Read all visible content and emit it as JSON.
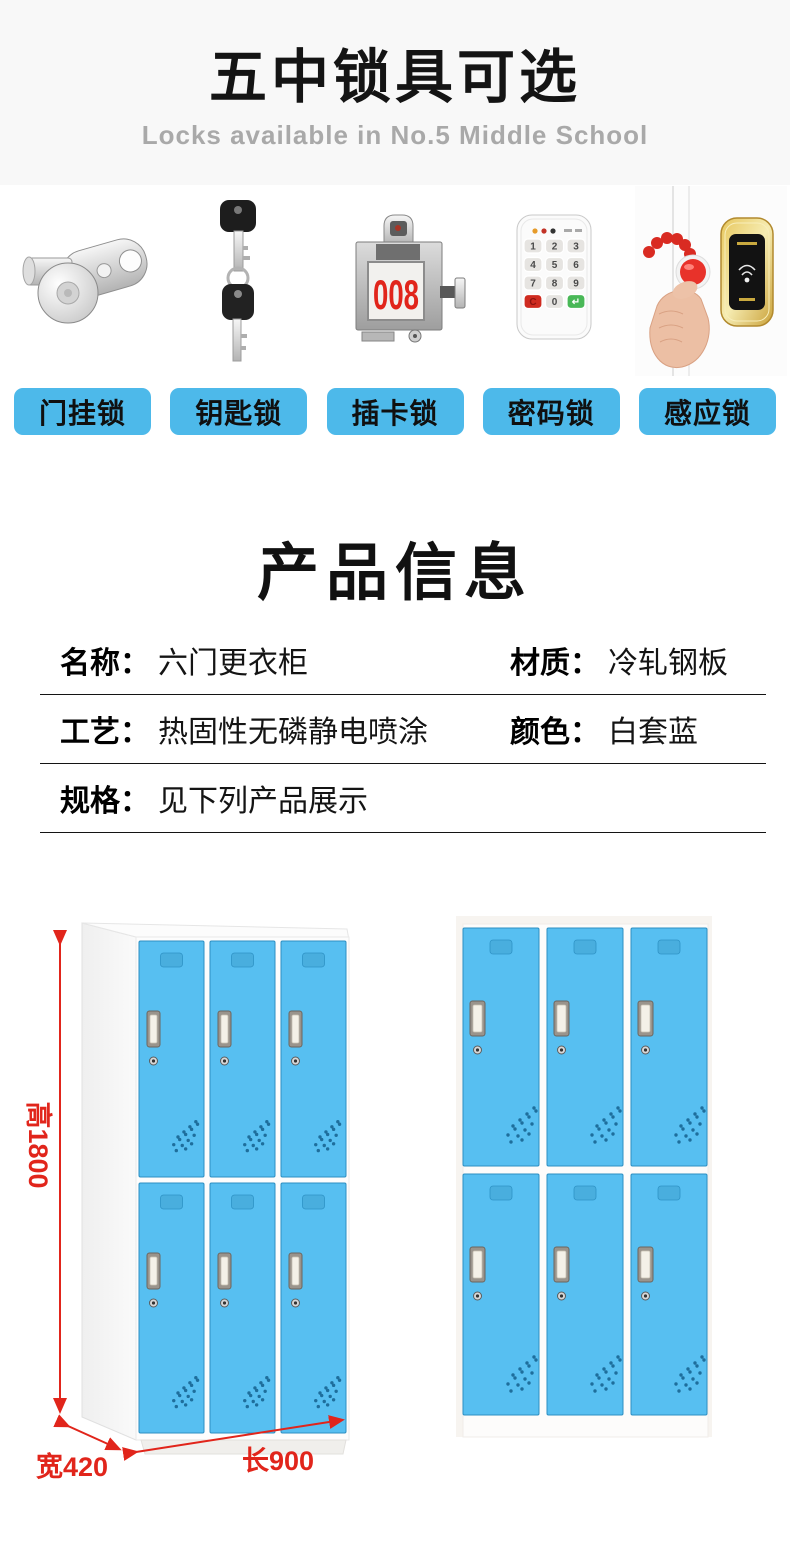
{
  "hero": {
    "title": "五中锁具可选",
    "subtitle": "Locks available in No.5 Middle School"
  },
  "locks": {
    "button_color": "#4db9ea",
    "items": [
      {
        "label": "门挂锁",
        "icon": "cam-lock-icon"
      },
      {
        "label": "钥匙锁",
        "icon": "key-lock-icon"
      },
      {
        "label": "插卡锁",
        "icon": "card-lock-icon",
        "display_number": "008"
      },
      {
        "label": "密码锁",
        "icon": "keypad-lock-icon",
        "keypad_keys": [
          "1",
          "2",
          "3",
          "4",
          "5",
          "6",
          "7",
          "8",
          "9",
          "C",
          "0",
          "↵"
        ]
      },
      {
        "label": "感应锁",
        "icon": "rfid-lock-icon"
      }
    ]
  },
  "product_info": {
    "title": "产品信息",
    "rows": [
      {
        "cells": [
          {
            "label": "名称：",
            "value": "六门更衣柜"
          },
          {
            "label": "材质：",
            "value": "冷轧钢板"
          }
        ]
      },
      {
        "cells": [
          {
            "label": "工艺：",
            "value": "热固性无磷静电喷涂"
          },
          {
            "label": "颜色：",
            "value": "白套蓝"
          }
        ]
      },
      {
        "cells": [
          {
            "label": "规格：",
            "value": "见下列产品展示"
          }
        ]
      }
    ]
  },
  "showcase": {
    "dim_height": "高1800",
    "dim_width": "宽420",
    "dim_length": "长900",
    "colors": {
      "door_blue": "#57bff1",
      "accent_red": "#e1251b",
      "button_blue": "#4db9ea"
    }
  }
}
